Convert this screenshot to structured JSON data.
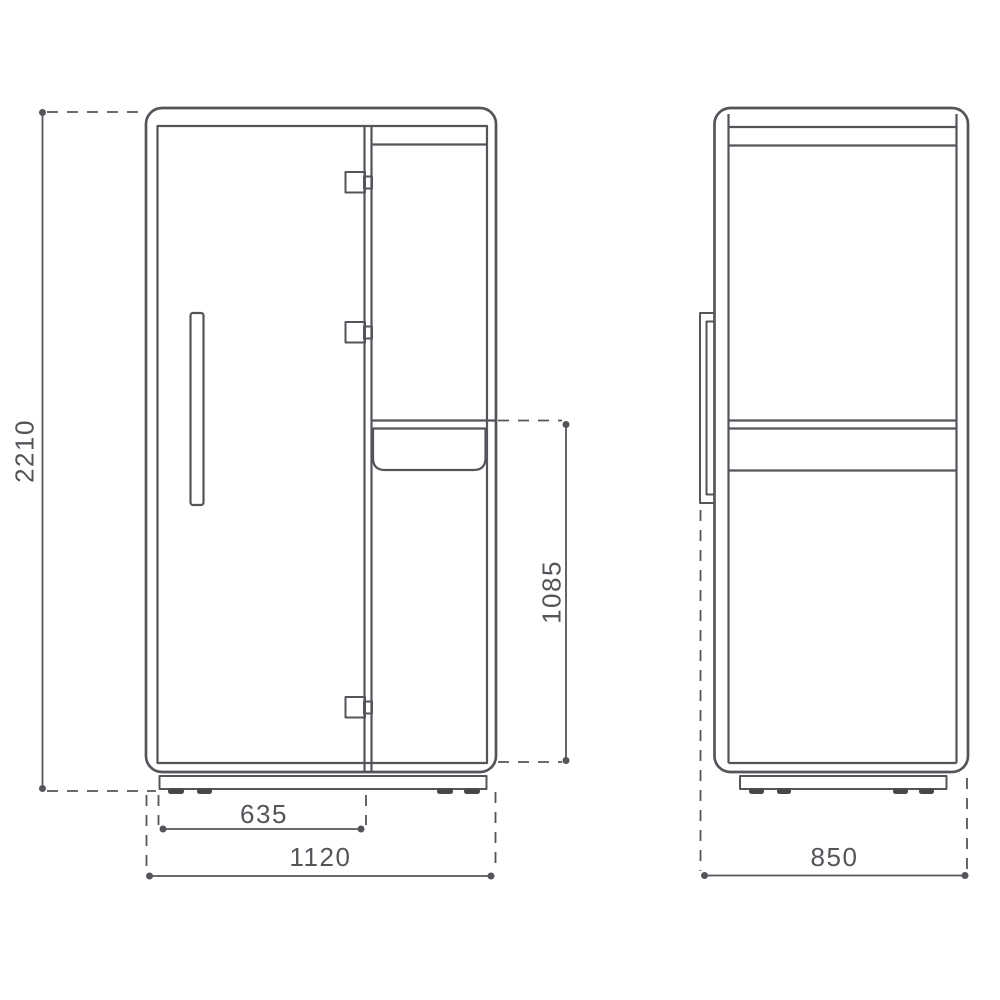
{
  "colors": {
    "line": "#54545a",
    "feet_fill": "#46464b",
    "background": "#ffffff"
  },
  "dimensions": {
    "overall_height": "2210",
    "overall_width": "1120",
    "door_width": "635",
    "tabletop_height": "1085",
    "overall_depth": "850"
  }
}
